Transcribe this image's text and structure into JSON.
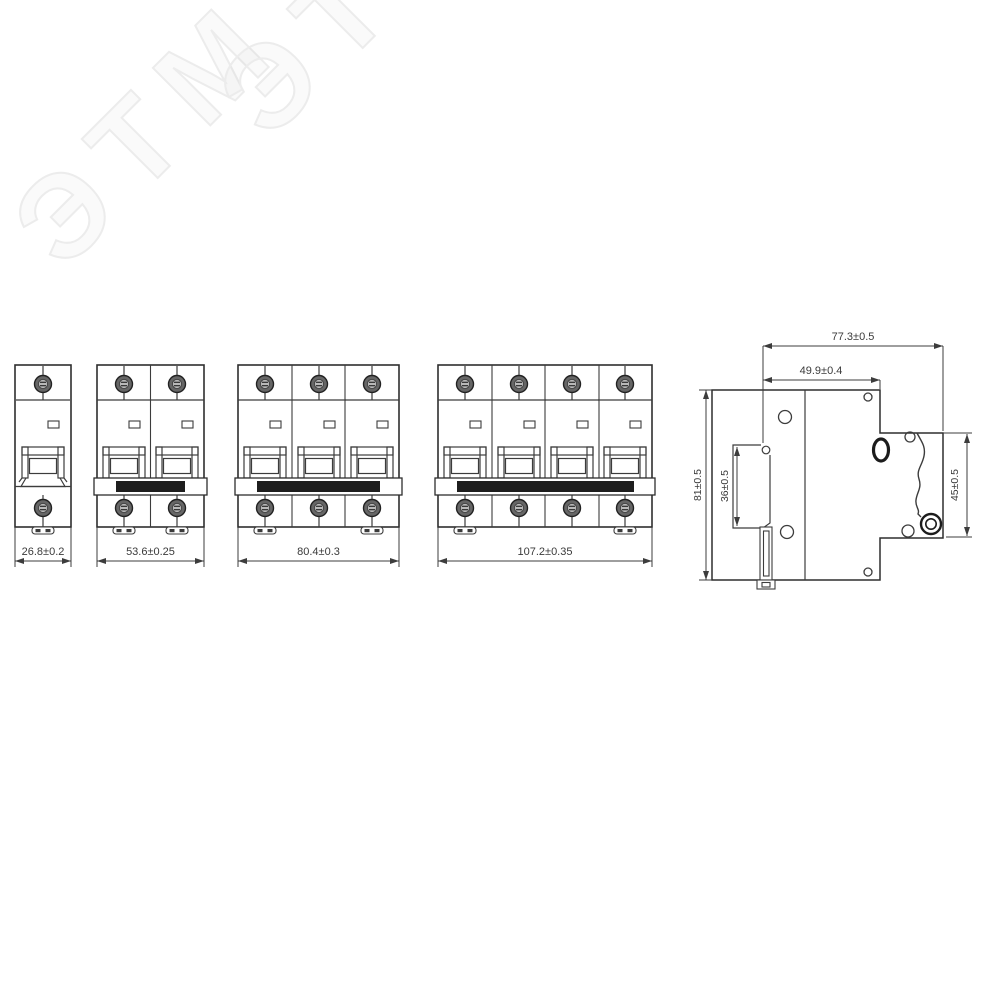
{
  "watermark": {
    "text": "ЭТМ"
  },
  "diagram_title": "",
  "front_views": [
    {
      "poles": 1,
      "dim": "26.8±0.2"
    },
    {
      "poles": 2,
      "dim": "53.6±0.25"
    },
    {
      "poles": 3,
      "dim": "80.4±0.3"
    },
    {
      "poles": 4,
      "dim": "107.2±0.35"
    }
  ],
  "side_view": {
    "dim_depth_total": "77.3±0.5",
    "dim_depth_body": "49.9±0.4",
    "dim_height": "81±0.5",
    "dim_recess": "36±0.5",
    "dim_front": "45±0.5"
  },
  "colors": {
    "line": "#3c3c3c",
    "tie_bar": "#1e1e1e",
    "watermark_outline": "#ececec",
    "background": "#ffffff"
  }
}
